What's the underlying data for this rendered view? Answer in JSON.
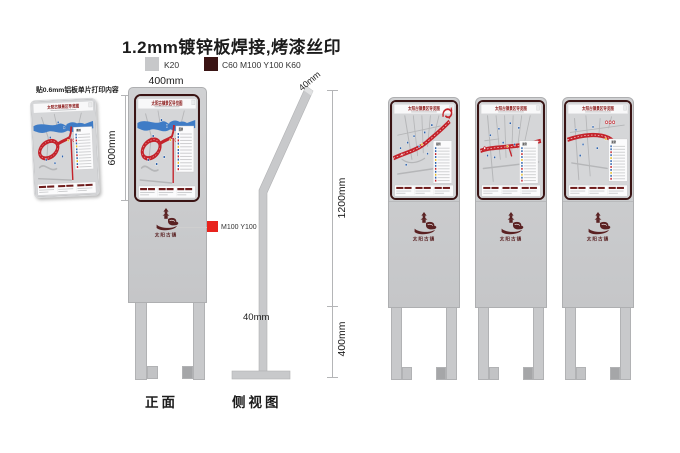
{
  "header": {
    "title": "1.2mm镀锌板焊接,烤漆丝印",
    "materials": [
      {
        "label": "K20"
      },
      {
        "label": "C60 M100 Y100 K60"
      }
    ]
  },
  "colors": {
    "k20": "#c7c8ca",
    "c60m100y100k60": "#3a1414",
    "m100y100": "#e8231d"
  },
  "note": "贴0.6mm铝板单片打印内容",
  "front": {
    "label": "正面",
    "width": "400mm",
    "height": "600mm",
    "logo_color_label": "M100 Y100"
  },
  "side": {
    "label": "侧视图",
    "panel_thickness": "40mm",
    "upper_height": "1200mm",
    "lower_height": "400mm",
    "post_width": "40mm"
  },
  "map": {
    "title": "太阳古镇景区导览图",
    "legend_title": "图例"
  },
  "logo": {
    "text": "太阳古镇"
  }
}
